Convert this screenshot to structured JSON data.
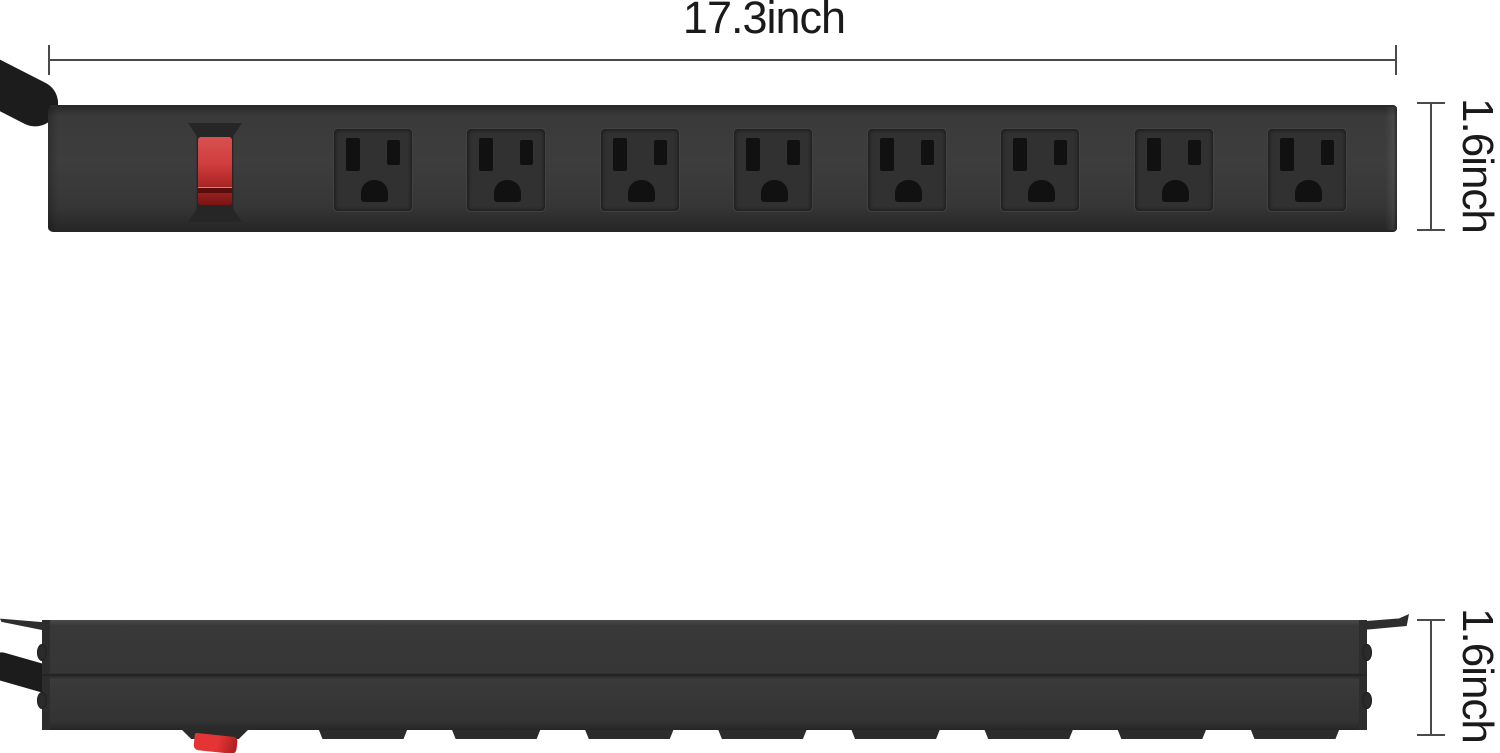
{
  "page": {
    "background": "#ffffff",
    "description": "Product dimension diagram of a wall-mountable 8-outlet metal power strip shown in front view (top) and side profile view (bottom)"
  },
  "dimensions": {
    "width_label": "17.3inch",
    "front_height_label": "1.6inch",
    "side_height_label": "1.6inch"
  },
  "product": {
    "name": "8-outlet power strip with red power switch",
    "outlet_count": 8,
    "outlet_type": "NEMA 5-15 three-prong",
    "views": {
      "front": "face with red rocker power switch and 8 outlets",
      "side": "profile with mounting ears, end screws, power cord and outlet-module tabs"
    }
  },
  "colors": {
    "body": "#363636",
    "outlet_slot": "#111111",
    "switch_red": "#c73535",
    "cable": "#1c1c1c",
    "dimension_line": "#4a4a4a",
    "label_text": "#1a1a1a"
  }
}
